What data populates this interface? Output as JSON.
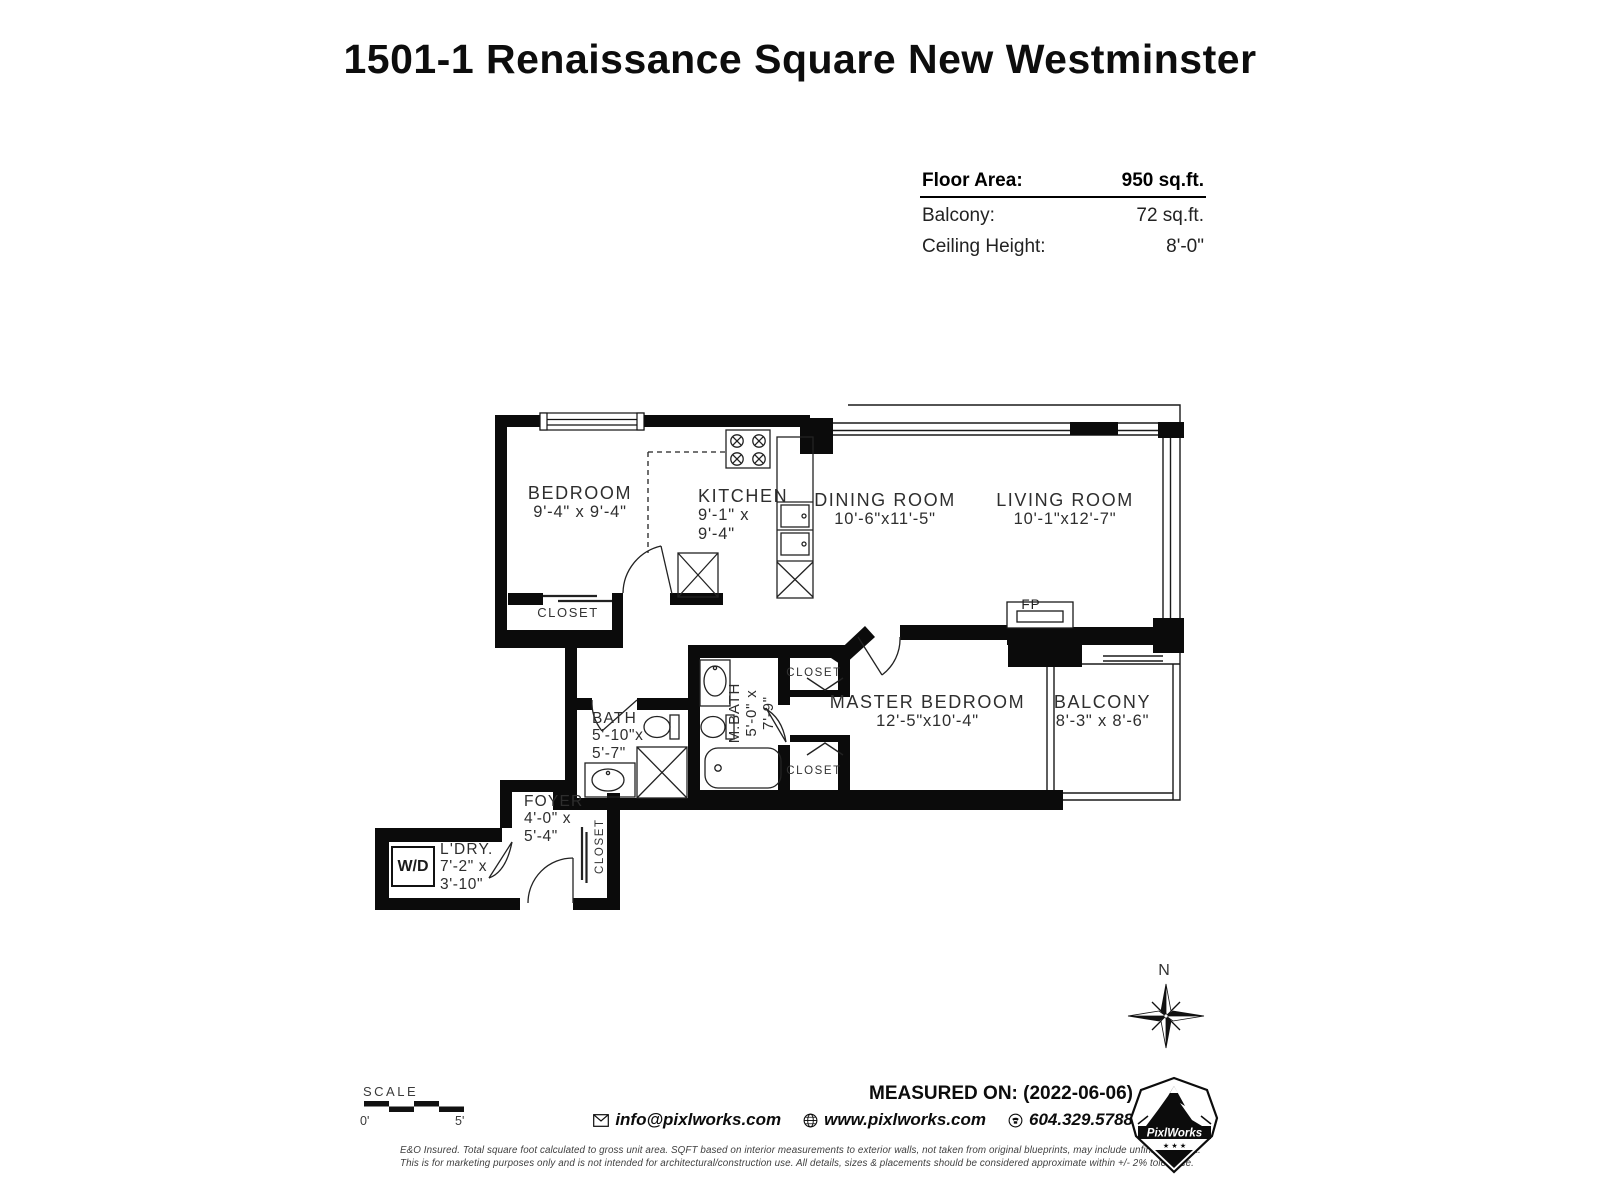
{
  "title": "1501-1 Renaissance Square New Westminster",
  "info_panel": {
    "floor_area_label": "Floor Area:",
    "floor_area_value": "950 sq.ft.",
    "balcony_label": "Balcony:",
    "balcony_value": "72 sq.ft.",
    "ceiling_label": "Ceiling Height:",
    "ceiling_value": "8'-0\""
  },
  "plan": {
    "bedroom": {
      "name": "BEDROOM",
      "dims": "9'-4\" x 9'-4\""
    },
    "kitchen": {
      "name": "KITCHEN",
      "dims_line1": "9'-1\" x",
      "dims_line2": "9'-4\""
    },
    "dining": {
      "name": "DINING ROOM",
      "dims": "10'-6\"x11'-5\""
    },
    "living": {
      "name": "LIVING ROOM",
      "dims": "10'-1\"x12'-7\""
    },
    "master": {
      "name": "MASTER BEDROOM",
      "dims": "12'-5\"x10'-4\""
    },
    "balcony": {
      "name": "BALCONY",
      "dims": "8'-3\" x 8'-6\""
    },
    "mbath": {
      "name": "M.BATH",
      "dims_line1": "5'-0\" x",
      "dims_line2": "7'-9\""
    },
    "bath": {
      "name": "BATH",
      "dims_line1": "5'-10\"x",
      "dims_line2": "5'-7\""
    },
    "foyer": {
      "name": "FOYER",
      "dims_line1": "4'-0\" x",
      "dims_line2": "5'-4\""
    },
    "laundry": {
      "name": "L'DRY.",
      "dims_line1": "7'-2\" x",
      "dims_line2": "3'-10\""
    },
    "closet_bedroom": "CLOSET",
    "closet_master_1": "CLOSET",
    "closet_master_2": "CLOSET",
    "closet_foyer": "CLOSET",
    "washer_dryer": "W/D",
    "fireplace": "FP"
  },
  "compass": {
    "north_label": "N"
  },
  "scale_bar": {
    "label": "SCALE",
    "start": "0'",
    "end": "5'"
  },
  "footer": {
    "measured_on": "MEASURED ON: (2022-06-06)",
    "email": "info@pixlworks.com",
    "website": "www.pixlworks.com",
    "phone": "604.329.5788",
    "disclaimer_line1": "E&O Insured.  Total square foot calculated to gross unit area. SQFT based on interior measurements to exterior walls, not taken from original blueprints, may include unfinished area.",
    "disclaimer_line2": "This is for marketing purposes only and is not intended for architectural/construction use.  All details, sizes & placements should be considered approximate within +/- 2%  tolerance.",
    "logo_text": "PixlWorks",
    "logo_stars": "★ ★ ★"
  }
}
